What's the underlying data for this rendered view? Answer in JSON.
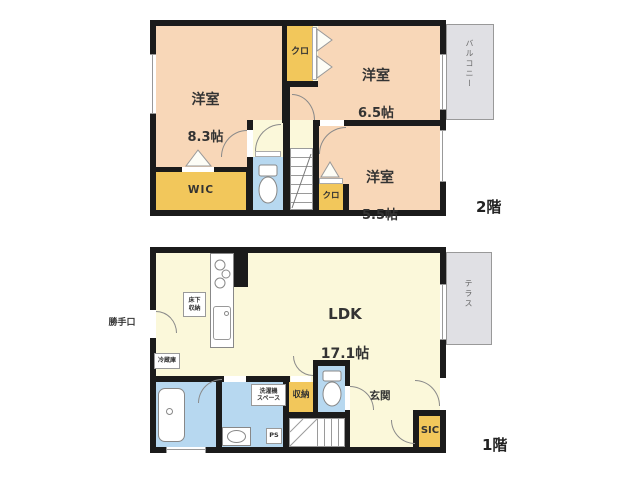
{
  "colors": {
    "wall": "#1b1b1b",
    "room_peach": "#f8d7b8",
    "closet_yellow": "#f2c75b",
    "living_cream": "#fbf8da",
    "sanitary_blue": "#b7d8f0",
    "outdoor_gray": "#e0e0e4"
  },
  "floor2": {
    "floor_label": "2階",
    "room_83": {
      "name": "洋室",
      "size": "8.3帖"
    },
    "room_65": {
      "name": "洋室",
      "size": "6.5帖"
    },
    "room_55": {
      "name": "洋室",
      "size": "5.5帖"
    },
    "closet_top": {
      "label": "クロ"
    },
    "closet_bottom": {
      "label": "クロ"
    },
    "wic": {
      "label": "WIC"
    },
    "balcony": {
      "label": "バルコニー"
    }
  },
  "floor1": {
    "floor_label": "1階",
    "ldk": {
      "name": "LDK",
      "size": "17.1帖"
    },
    "underfloor_storage": {
      "label": "床下\n収納"
    },
    "back_door": {
      "label": "勝手口"
    },
    "refrigerator": {
      "label": "冷蔵庫"
    },
    "laundry_space": {
      "label": "洗濯機\nスペース"
    },
    "storage": {
      "label": "収納"
    },
    "entrance": {
      "label": "玄関"
    },
    "sic": {
      "label": "SIC"
    },
    "ps": {
      "label": "PS"
    },
    "terrace": {
      "label": "テラス"
    }
  }
}
